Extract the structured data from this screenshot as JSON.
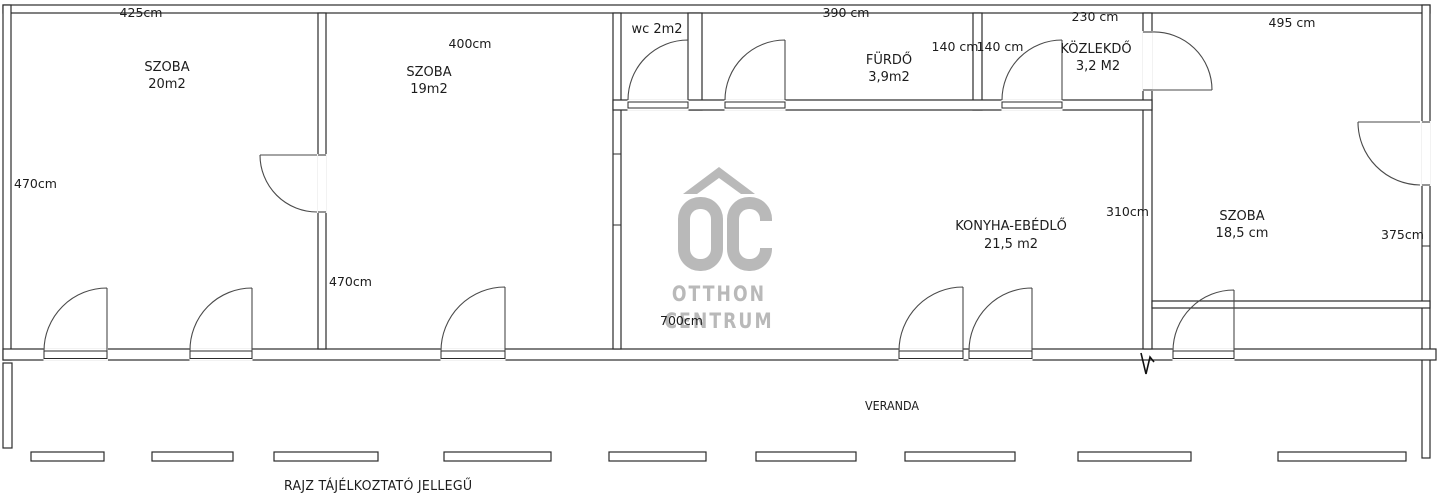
{
  "colors": {
    "wall": "#2b2b2b",
    "door": "#4a4a4a",
    "watermark": "#b9b9b9"
  },
  "rooms": {
    "szoba1": {
      "name": "SZOBA",
      "area": "20m2",
      "dim_top": "425cm",
      "dim_left": "470cm"
    },
    "szoba2": {
      "name": "SZOBA",
      "area": "19m2",
      "dim_top": "400cm",
      "dim_left": "470cm"
    },
    "wc": {
      "label": "wc 2m2"
    },
    "furdo": {
      "name": "FÜRDŐ",
      "area": "3,9m2",
      "dim_top": "390 cm",
      "dim_left": "140 cm",
      "dim_right": "140 cm"
    },
    "kozlekdo": {
      "name": "KÖZLEKDŐ",
      "area": "3,2 M2",
      "dim_top": "230 cm"
    },
    "konyha": {
      "name": "KONYHA-EBÉDLŐ",
      "area": "21,5 m2",
      "dim_bottom": "700cm",
      "dim_right": "310cm"
    },
    "szoba3": {
      "name": "SZOBA",
      "area": "18,5 cm",
      "dim_top": "495 cm",
      "dim_right": "375cm"
    },
    "veranda": {
      "name": "VERANDA"
    }
  },
  "watermark": {
    "logo": "OC",
    "line1": "OTTHON",
    "line2": "CENTRUM"
  },
  "footer": {
    "disclaimer": "RAJZ TÁJÉLKOZTATÓ JELLEGŰ"
  }
}
